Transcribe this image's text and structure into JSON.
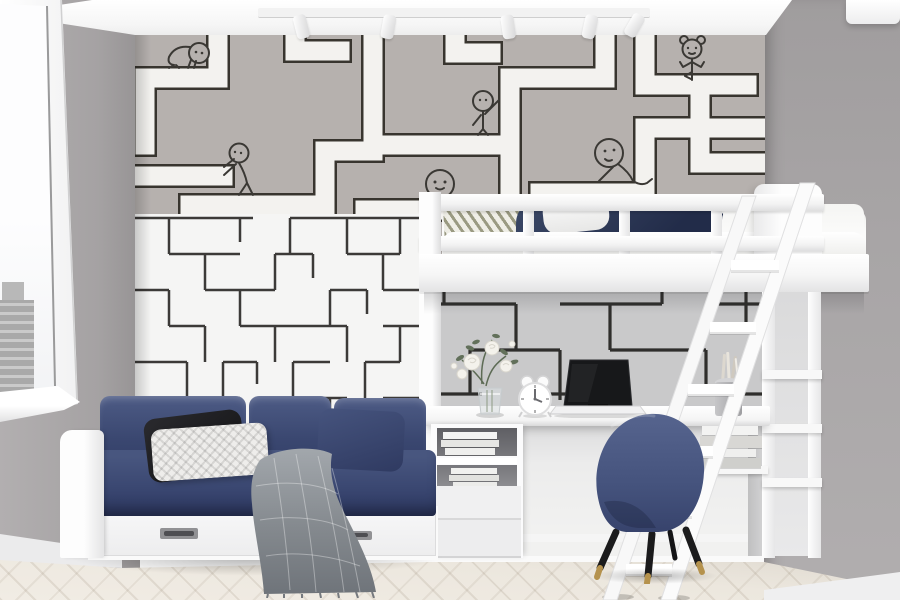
{
  "scene": {
    "title": "Children's bedroom with maze wallpaper, loft bed and navy daybed",
    "view": "interior photo",
    "room": "kids bedroom"
  },
  "palette": {
    "ceiling": "#fafafa",
    "wall_left": "#a7a4a5",
    "wall_right": "#a8a5a6",
    "maze_top_bg": "#b6b1ae",
    "maze_path_white": "#f3f2ef",
    "maze_line_dark": "#38352f",
    "maze_lower_bg": "#f5f5f4",
    "maze_lower_line": "#3c3a38",
    "desk_wall_bg": "#c9c9ca",
    "desk_wall_line": "#2f2e2c",
    "furniture_white": "#fbfbfb",
    "sofa_navy": "#45537d",
    "sofa_navy_dark": "#303c63",
    "pillow_black": "#1d1d1f",
    "pillow_white": "#ececec",
    "blanket_gray": "#8f9499",
    "chair_navy": "#4b5a82",
    "leg_black": "#1b1b1c",
    "leg_brass": "#b5924d",
    "floor_wood": "#e9e4db",
    "laptop_dark": "#17181a"
  },
  "wallpaper": {
    "label": "maze wallpaper with cartoon kids",
    "figures": [
      {
        "name": "crawling-kid",
        "pose": "crawling along a maze path"
      },
      {
        "name": "pushing-kid",
        "pose": "pushing against a maze wall"
      },
      {
        "name": "waving-kid",
        "pose": "standing and holding a maze wall"
      },
      {
        "name": "peeking-kid",
        "pose": "peeking over the loft bed rail"
      },
      {
        "name": "sitting-kid",
        "pose": "sitting on a maze path"
      },
      {
        "name": "pigtail-girl",
        "pose": "balancing on a maze path"
      }
    ]
  },
  "objects": {
    "window": {
      "label": "Window with city view"
    },
    "track_light": {
      "label": "Ceiling track light",
      "spot_count": 5
    },
    "loft_bed": {
      "label": "White loft bed with navy bedding"
    },
    "ladder": {
      "label": "White loft-bed ladder",
      "rung_count": 6
    },
    "sofa": {
      "label": "Navy daybed with storage drawers",
      "drawer_count": 2,
      "pillows": [
        "black",
        "white knit",
        "navy"
      ],
      "throw": "gray knit blanket"
    },
    "desk": {
      "label": "Built-in white desk",
      "items": [
        "white roses in glass vase",
        "white alarm clock",
        "open laptop",
        "pen cup with pencils"
      ]
    },
    "chair": {
      "label": "Navy upholstered desk chair with brass-tipped legs"
    },
    "floor": {
      "label": "Light herringbone parquet"
    }
  }
}
